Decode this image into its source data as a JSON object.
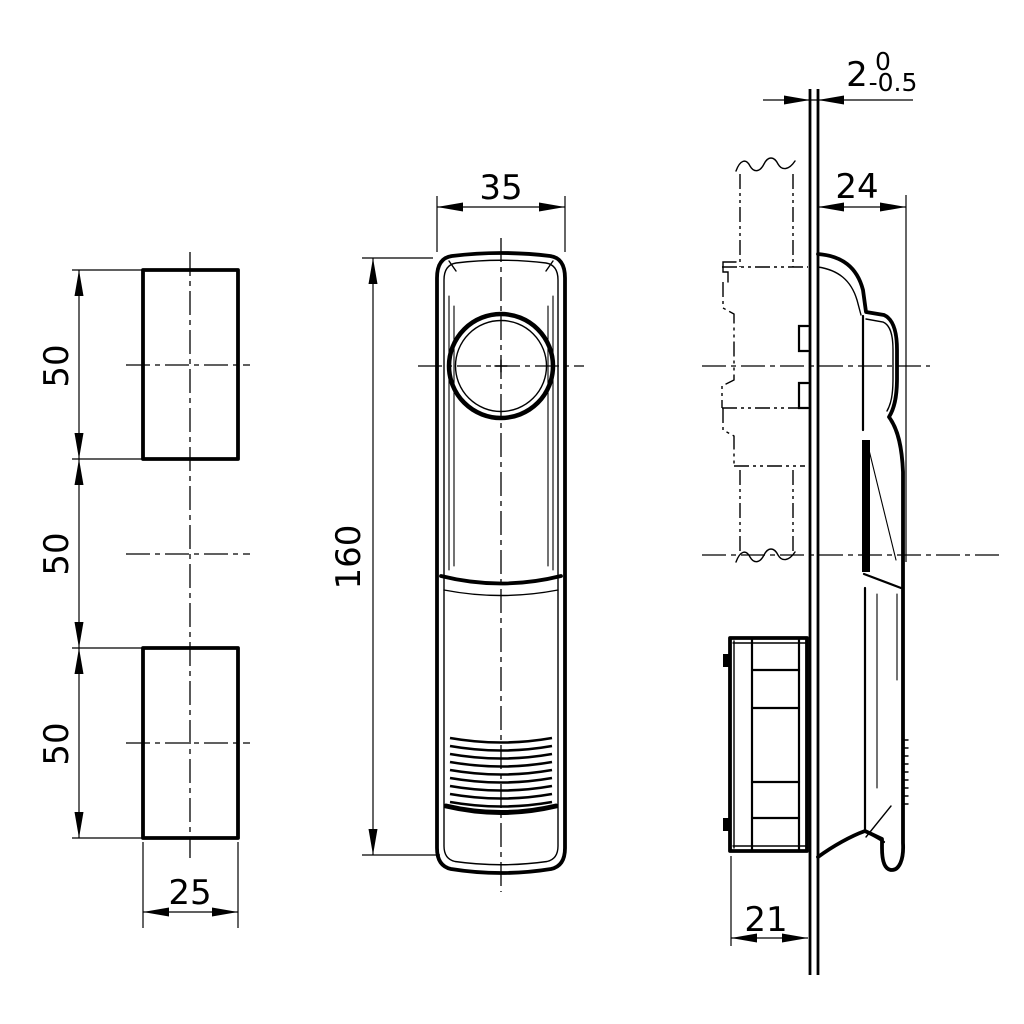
{
  "drawing_type": "technical-orthographic-drawing",
  "colors": {
    "ink": "#000000",
    "paper": "#ffffff"
  },
  "views": {
    "cutout": {
      "description": "panel cutout / mounting holes view",
      "dim_top": "50",
      "dim_gap": "50",
      "dim_bottom": "50",
      "dim_width": "25"
    },
    "front": {
      "description": "front view of handle",
      "dim_width": "35",
      "dim_height": "160"
    },
    "side": {
      "description": "side view with panel and rear housing",
      "dim_thickness": "2",
      "tol_upper": "0",
      "tol_lower": "-0.5",
      "dim_front_depth": "24",
      "dim_rear_depth": "21"
    }
  }
}
